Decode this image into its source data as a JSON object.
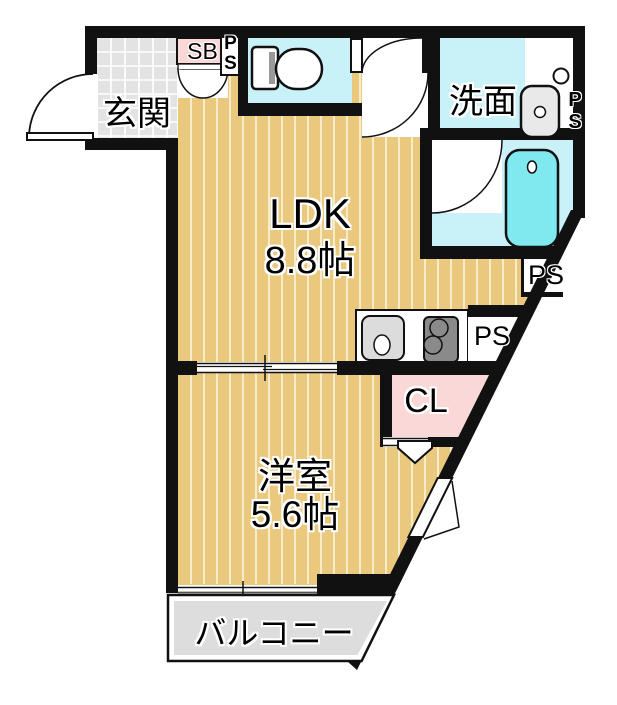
{
  "rooms": {
    "entrance": {
      "label": "玄関"
    },
    "shoe_box": {
      "label": "SB"
    },
    "pipe_shaft_top": {
      "label": "P\nS"
    },
    "washroom": {
      "label": "洗面"
    },
    "pipe_shaft_right": {
      "label": "P\nS"
    },
    "ldk": {
      "label": "LDK",
      "size": "8.8帖"
    },
    "pipe_shaft_bath": {
      "label": "PS"
    },
    "pipe_shaft_kitchen": {
      "label": "PS"
    },
    "closet": {
      "label": "CL"
    },
    "western_room": {
      "label": "洋室",
      "size": "5.6帖"
    },
    "balcony": {
      "label": "バルコニー"
    }
  },
  "colors": {
    "wall": "#111111",
    "floor_wood": "#eac87d",
    "floor_stripe": "#f7ecc9",
    "wet_area_cyan": "#c9f1f8",
    "bathtub_cyan": "#80e9f0",
    "accent_pink": "#fbd8d8",
    "entrance_tile_gray": "#e3e3e3",
    "balcony_gray": "#dddddd",
    "fixture_gray": "#e9e9e9",
    "stove_gray": "#8a8a8a"
  }
}
